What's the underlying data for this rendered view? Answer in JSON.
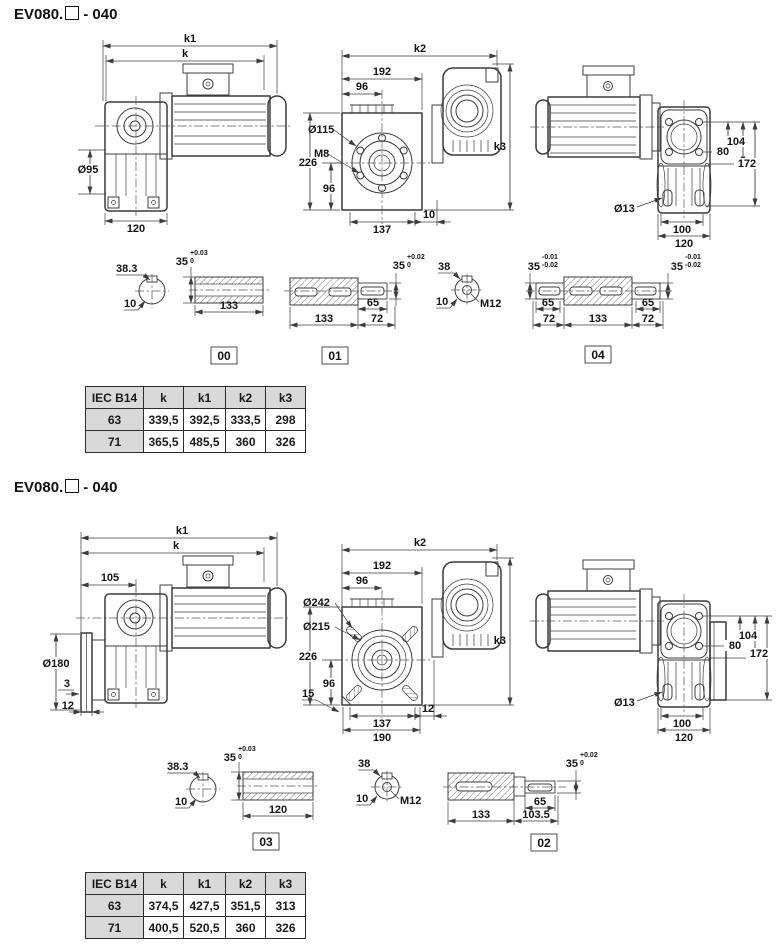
{
  "sections": [
    {
      "title_prefix": "EV080.",
      "title_suffix": "- 040",
      "side": {
        "k1": "k1",
        "k": "k",
        "dia": "Ø95",
        "base": "120"
      },
      "front": {
        "k2": "k2",
        "w192": "192",
        "w96": "96",
        "dia1": "Ø115",
        "bolt": "M8",
        "h226": "226",
        "h96": "96",
        "w137": "137",
        "off": "10",
        "k3": "k3"
      },
      "rear": {
        "h80": "80",
        "h104": "104",
        "h172": "172",
        "dia": "Ø13",
        "w100": "100",
        "w120": "120"
      },
      "cross_a": {
        "dim": "38.3",
        "key": "10"
      },
      "hollow": {
        "dia": "35",
        "tol_top": "+0.03",
        "tol_bot": "0",
        "len": "133",
        "tag": "00"
      },
      "output": {
        "dia": "35",
        "tol_top": "+0.02",
        "tol_bot": "0",
        "len": "133",
        "key_len": "65",
        "ext": "72",
        "tag": "01"
      },
      "cross_b": {
        "dim": "38",
        "key": "10",
        "thread": "M12"
      },
      "double": {
        "dia_l": "35",
        "tol_l1": "-0.01",
        "tol_l2": "-0.02",
        "dia_r": "35",
        "tol_r1": "-0.01",
        "tol_r2": "-0.02",
        "key_l": "65",
        "ext_l": "72",
        "len": "133",
        "key_r": "65",
        "ext_r": "72",
        "tag": "04"
      },
      "table": {
        "headers": [
          "IEC B14",
          "k",
          "k1",
          "k2",
          "k3"
        ],
        "rows": [
          [
            "63",
            "339,5",
            "392,5",
            "333,5",
            "298"
          ],
          [
            "71",
            "365,5",
            "485,5",
            "360",
            "326"
          ]
        ]
      }
    },
    {
      "title_prefix": "EV080.",
      "title_suffix": "- 040",
      "side": {
        "k1": "k1",
        "k": "k",
        "w105": "105",
        "dia": "Ø180",
        "lip": "3",
        "thick": "12"
      },
      "front": {
        "k2": "k2",
        "w192": "192",
        "w96": "96",
        "dia1": "Ø242",
        "dia2": "Ø215",
        "h226": "226",
        "h96": "96",
        "cham": "15",
        "w137": "137",
        "off": "12",
        "w190": "190",
        "k3": "k3"
      },
      "rear": {
        "h80": "80",
        "h104": "104",
        "h172": "172",
        "dia": "Ø13",
        "w100": "100",
        "w120": "120"
      },
      "cross_a": {
        "dim": "38.3",
        "key": "10"
      },
      "hollow": {
        "dia": "35",
        "tol_top": "+0.03",
        "tol_bot": "0",
        "len": "120",
        "tag": "03"
      },
      "cross_b": {
        "dim": "38",
        "key": "10",
        "thread": "M12"
      },
      "output": {
        "dia": "35",
        "tol_top": "+0.02",
        "tol_bot": "0",
        "len": "133",
        "ext": "103.5",
        "key_len": "65",
        "tag": "02"
      },
      "table": {
        "headers": [
          "IEC B14",
          "k",
          "k1",
          "k2",
          "k3"
        ],
        "rows": [
          [
            "63",
            "374,5",
            "427,5",
            "351,5",
            "313"
          ],
          [
            "71",
            "400,5",
            "520,5",
            "360",
            "326"
          ]
        ]
      }
    }
  ]
}
